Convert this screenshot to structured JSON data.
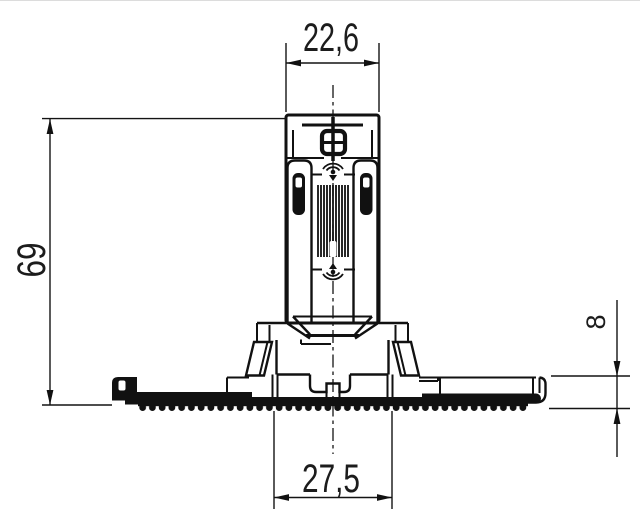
{
  "drawing": {
    "background": "#ffffff",
    "line_color": "#111111",
    "dimensions": {
      "top_width": "22,6",
      "overall_height": "69",
      "base_height": "8",
      "base_width": "27,5"
    }
  }
}
